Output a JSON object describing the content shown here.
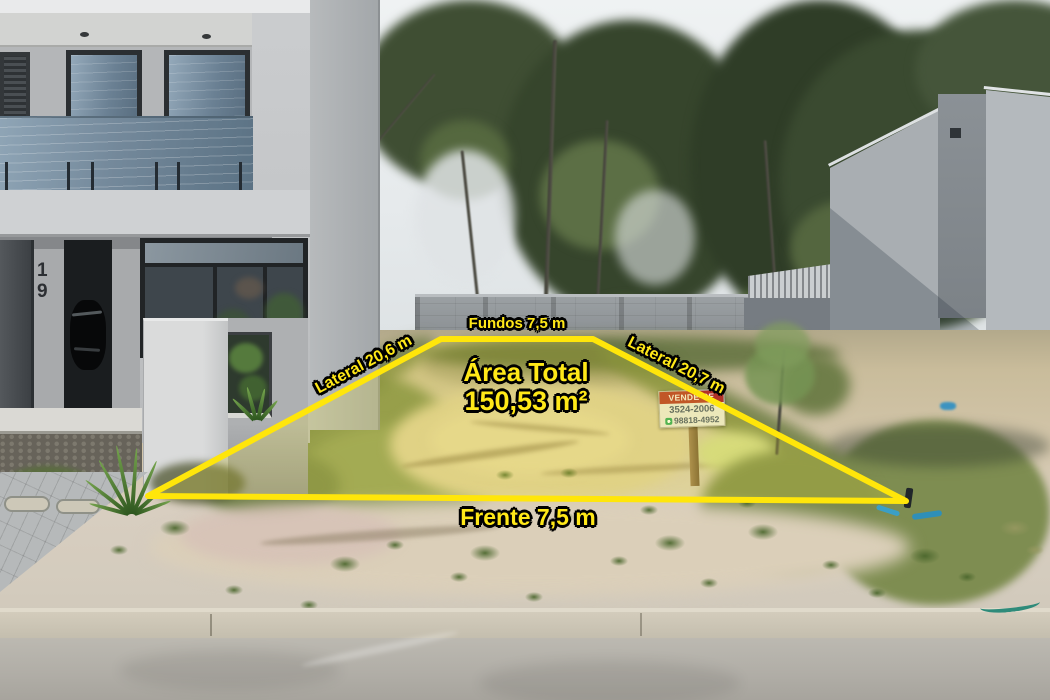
{
  "lot_annotations": {
    "back": "Fundos 7,5 m",
    "side_left": "Lateral 20,6 m",
    "side_right": "Lateral 20,7 m",
    "front": "Frente 7,5 m",
    "area_title": "Área Total",
    "area_value": "150,53 m²",
    "outline_color": "#ffe60a",
    "text_color": "#ffe818"
  },
  "sale_sign": {
    "title": "VENDE-SE",
    "phone_line1": "3524-2006",
    "phone_line2": "98818-4952",
    "header_color": "#b23127",
    "whatsapp_green": "#27a45c"
  },
  "neighbor_house": {
    "number": "19"
  }
}
